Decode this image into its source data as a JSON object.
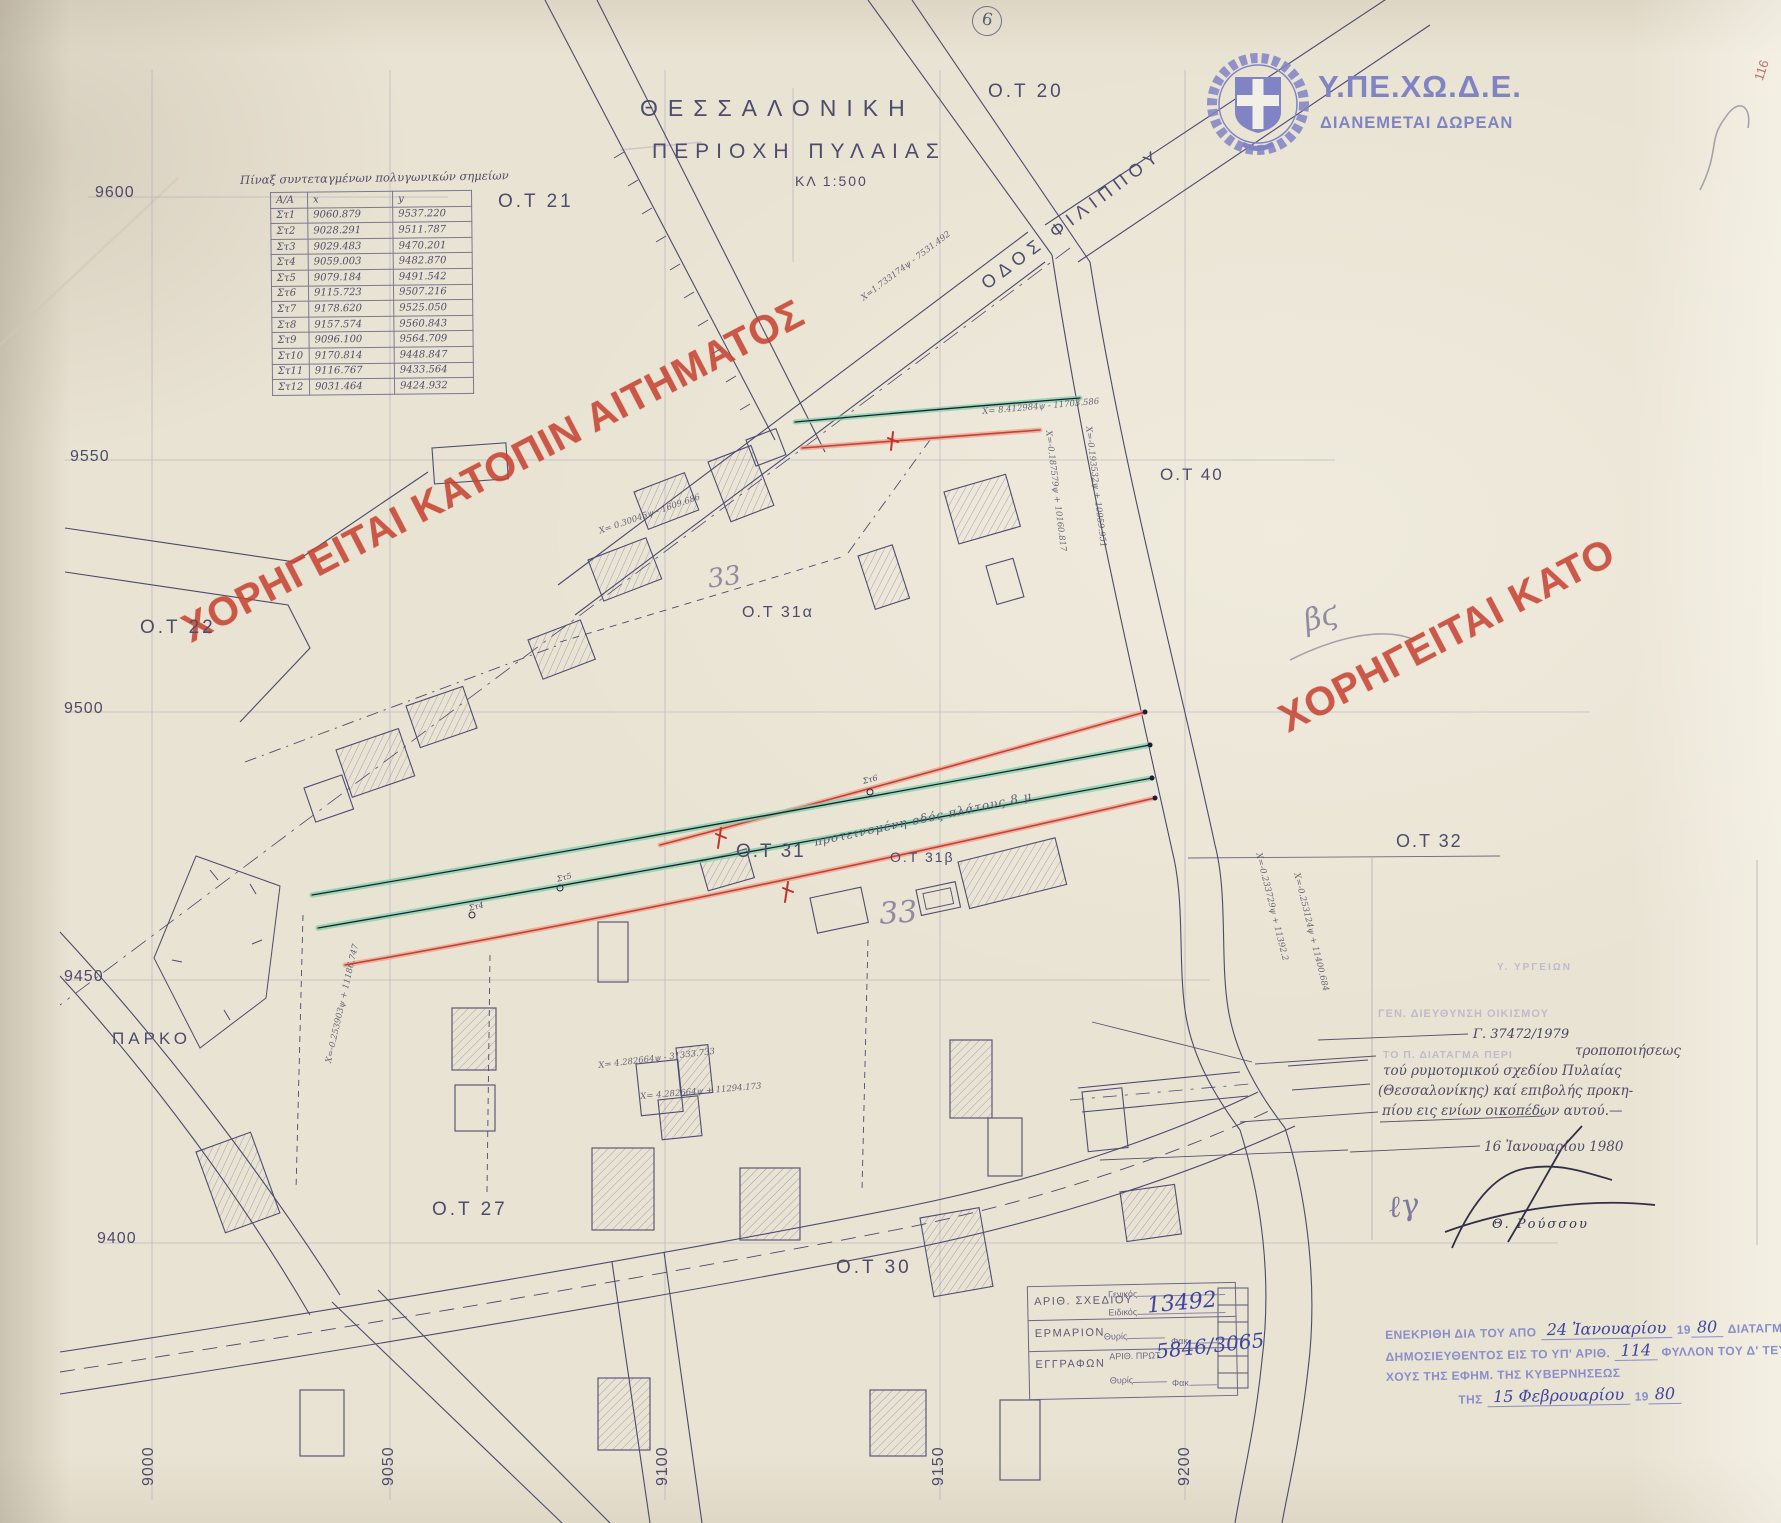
{
  "header": {
    "city": "ΘΕΣΣΑΛΟΝΙΚΗ",
    "area": "ΠΕΡΙΟΧΗ ΠΥΛΑΙΑΣ",
    "scale": "ΚΛ 1:500"
  },
  "agency": {
    "name": "Υ.ΠΕ.ΧΩ.Δ.Ε.",
    "distribution": "ΔΙΑΝΕΜΕΤΑΙ ΔΩΡΕΑΝ",
    "corner_number": "116",
    "brand_color": "#8084c4"
  },
  "watermark": {
    "main": "ΧΟΡΗΓΕΙΤΑΙ ΚΑΤΟΠΙΝ ΑΙΤΗΜΑΤΟΣ",
    "right": "ΧΟΡΗΓΕΙΤΑΙ ΚΑΤΟ",
    "color": "#c6402f"
  },
  "coord_table": {
    "title": "Πίναξ συντεταγμένων πολυγωνικών σημείων",
    "columns": {
      "aa": "Α/Α",
      "x": "x",
      "y": "y"
    },
    "rows": [
      {
        "id": "Στ1",
        "x": "9060.879",
        "y": "9537.220"
      },
      {
        "id": "Στ2",
        "x": "9028.291",
        "y": "9511.787"
      },
      {
        "id": "Στ3",
        "x": "9029.483",
        "y": "9470.201"
      },
      {
        "id": "Στ4",
        "x": "9059.003",
        "y": "9482.870"
      },
      {
        "id": "Στ5",
        "x": "9079.184",
        "y": "9491.542"
      },
      {
        "id": "Στ6",
        "x": "9115.723",
        "y": "9507.216"
      },
      {
        "id": "Στ7",
        "x": "9178.620",
        "y": "9525.050"
      },
      {
        "id": "Στ8",
        "x": "9157.574",
        "y": "9560.843"
      },
      {
        "id": "Στ9",
        "x": "9096.100",
        "y": "9564.709"
      },
      {
        "id": "Στ10",
        "x": "9170.814",
        "y": "9448.847"
      },
      {
        "id": "Στ11",
        "x": "9116.767",
        "y": "9433.564"
      },
      {
        "id": "Στ12",
        "x": "9031.464",
        "y": "9424.932"
      }
    ]
  },
  "grid": {
    "left_labels": [
      "9600",
      "9550",
      "9500",
      "9450",
      "9400"
    ],
    "bottom_labels": [
      "9000",
      "9050",
      "9100",
      "9150",
      "9200"
    ]
  },
  "blocks": [
    "Ο.Τ 20",
    "Ο.Τ 21",
    "Ο.Τ 22",
    "Ο.Τ 27",
    "Ο.Τ 30",
    "Ο.Τ 31",
    "Ο.Τ 31α",
    "Ο.Τ 31β",
    "Ο.Τ 32",
    "Ο.Τ 40"
  ],
  "labels": {
    "street": "ΟΔΟΣ ΦΙΛΙΠΠΟΥ",
    "park": "ΠΑΡΚΟ",
    "road_note": "προτεινομένη οδός πλάτους 8 μ",
    "circled_mark": "6"
  },
  "survey_points": [
    "Στ6",
    "Στ5",
    "Στ4"
  ],
  "equations": [
    "Χ=1.733174ψ - 7531.492",
    "Χ= 8.412984ψ - 11703.586",
    "Χ=-0.187579ψ + 10160.817",
    "Χ=-0.193532ψ + 10959.951",
    "Χ= 0.30045ψ - 1609.686",
    "Χ=-0.233729ψ + 11392.2",
    "Χ=-0.253124ψ + 11400.684",
    "Χ= 4.282664ψ - 31333.733",
    "Χ= 4.282664ψ + 11294.173",
    "Χ=-0.253903ψ + 11186.747"
  ],
  "pencil_marks": {
    "m1": "33",
    "m2": "33",
    "m3": "βϛ",
    "m4": "ℓγ"
  },
  "stamp_box": {
    "row1_label": "ΑΡΙΘ. ΣΧΕΔΙΟΥ",
    "generic": "Γενικός",
    "specific": "Ειδικός",
    "row1_value": "13492",
    "row2_label": "ΕΡΜΑΡΙΟΝ",
    "slot": "Θυρίς",
    "folder": "Φακ.",
    "row3_label": "ΕΓΓΡΑΦΩΝ",
    "protocol": "ΑΡΙΘ. ΠΡΩΤ.",
    "row3_value": "5846/3065"
  },
  "right_panel": {
    "faint_line1": "Υ. ΥΡΓΕΙΩΝ",
    "faint_line2": "ΓΕΝ. ΔΙΕΥΘΥΝΣΗ ΟΙΚΙΣΜΟΥ",
    "faint_line3": "ΤΟ Π. ΔΙΑΤΑΓΜΑ ΠΕΡΙ",
    "ref_number": "Γ. 37472/1979",
    "note_line1": "τροποποιήσεως",
    "note_line2": "τού ρυμοτομικού σχεδίου Πυλαίας",
    "note_line3": "(Θεσσαλονίκης) καί επιβολής προκη-",
    "note_line4": "πίου εις ενίων οικοπέδων αυτού.—",
    "date": "16 Ἰανουαρίου 1980",
    "signer": "Θ. Ρούσσου"
  },
  "approval": {
    "l1_pre": "ΕΝΕΚΡΙΘΗ ΔΙΑ ΤΟΥ ΑΠΟ",
    "l1_hand": "24 Ἰανουαρίου",
    "l1_year": "19",
    "l1_year_hand": "80",
    "l1_post": "ΔΙΑΤΑΓΜΑΤΟΣ",
    "l2_pre": "ΔΗΜΟΣΙΕΥΘΕΝΤΟΣ ΕΙΣ ΤΟ ΥΠ' ΑΡΙΘ.",
    "l2_hand": "114",
    "l2_post": "ΦΥΛΛΟΝ ΤΟΥ Δ' ΤΕΥ-",
    "l3": "ΧΟΥΣ ΤΗΣ ΕΦΗΜ. ΤΗΣ ΚΥΒΕΡΝΗΣΕΩΣ",
    "l4_pre": "ΤΗΣ",
    "l4_hand": "15 Φεβρουαρίου",
    "l4_year": "19",
    "l4_year_hand": "80"
  }
}
